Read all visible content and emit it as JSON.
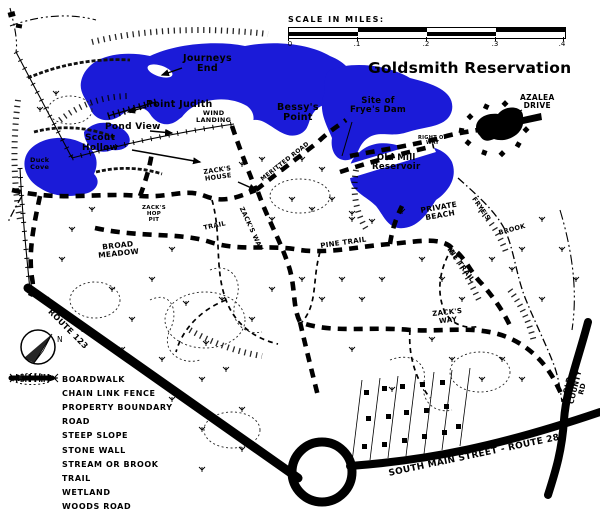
{
  "title": "Goldsmith Reservation",
  "scale": {
    "title": "SCALE IN MILES:",
    "ticks": [
      "0",
      ".1",
      ".2",
      ".3",
      ".4"
    ]
  },
  "compass": {
    "north_label": "N"
  },
  "colors": {
    "water": "#1b1bd8",
    "ink": "#000000"
  },
  "legend": {
    "items": [
      {
        "symbol": "boardwalk-icon",
        "label": "BOARDWALK"
      },
      {
        "symbol": "chain-link-fence-icon",
        "label": "CHAIN LINK FENCE"
      },
      {
        "symbol": "property-boundary-icon",
        "label": "PROPERTY BOUNDARY"
      },
      {
        "symbol": "road-icon",
        "label": "ROAD"
      },
      {
        "symbol": "steep-slope-icon",
        "label": "STEEP SLOPE"
      },
      {
        "symbol": "stone-wall-icon",
        "label": "STONE WALL"
      },
      {
        "symbol": "stream-or-brook-icon",
        "label": "STREAM OR BROOK"
      },
      {
        "symbol": "trail-icon",
        "label": "TRAIL"
      },
      {
        "symbol": "wetland-icon",
        "label": "WETLAND"
      },
      {
        "symbol": "woods-road-icon",
        "label": "WOODS ROAD"
      }
    ]
  },
  "map": {
    "labels": [
      {
        "name": "journeys-end",
        "text": "Journeys\nEnd",
        "x": 183,
        "y": 54,
        "size": 9.5,
        "bold": true
      },
      {
        "name": "point-judith",
        "text": "Point Judith",
        "x": 146,
        "y": 100,
        "size": 9.5,
        "bold": true
      },
      {
        "name": "pond-view",
        "text": "Pond View",
        "x": 105,
        "y": 123,
        "size": 9,
        "bold": true
      },
      {
        "name": "scout-hollow",
        "text": "Scout\nHollow",
        "x": 82,
        "y": 134,
        "size": 9,
        "bold": true
      },
      {
        "name": "wind-landing",
        "text": "WIND\nLANDING",
        "x": 196,
        "y": 110,
        "size": 6.5
      },
      {
        "name": "bessys-point",
        "text": "Bessy's\nPoint",
        "x": 277,
        "y": 103,
        "size": 9.5,
        "bold": true
      },
      {
        "name": "site-of-fryes-dam",
        "text": "Site of\nFrye's Dam",
        "x": 350,
        "y": 97,
        "size": 8.5,
        "bold": true
      },
      {
        "name": "old-mill-reservoir",
        "text": "Old Mill\nReservoir",
        "x": 372,
        "y": 154,
        "size": 8.5,
        "bold": true
      },
      {
        "name": "azalea-drive",
        "text": "AZALEA\nDRIVE",
        "x": 520,
        "y": 94,
        "size": 7.5
      },
      {
        "name": "right-of-way",
        "text": "RIGHT OF\nWAY",
        "x": 418,
        "y": 136,
        "size": 5
      },
      {
        "name": "duck-cove",
        "text": "Duck\nCove",
        "x": 30,
        "y": 157,
        "size": 6.5,
        "bold": true
      },
      {
        "name": "fryes-brook-1",
        "text": "FRYE'S",
        "x": 476,
        "y": 196,
        "size": 6.5,
        "rot": 55
      },
      {
        "name": "fryes-brook-2",
        "text": "BROOK",
        "x": 498,
        "y": 230,
        "size": 6.5,
        "rot": -15
      },
      {
        "name": "private-beach",
        "text": "PRIVATE\nBEACH",
        "x": 420,
        "y": 207,
        "size": 7.5,
        "rot": -10
      },
      {
        "name": "pine-trail-west",
        "text": "PINE TRAIL",
        "x": 320,
        "y": 243,
        "size": 7,
        "rot": -8
      },
      {
        "name": "pine-trail-east",
        "text": "PINE TRAIL",
        "x": 448,
        "y": 242,
        "size": 7,
        "rot": 54
      },
      {
        "name": "trail",
        "text": "TRAIL",
        "x": 203,
        "y": 225,
        "size": 6.5,
        "rot": -12
      },
      {
        "name": "zacks-house",
        "text": "ZACK'S\nHOUSE",
        "x": 203,
        "y": 169,
        "size": 6.5,
        "rot": -8
      },
      {
        "name": "zacks-hop-pit",
        "text": "ZACK'S\nHOP\nPIT",
        "x": 142,
        "y": 206,
        "size": 5.5
      },
      {
        "name": "broad-meadow",
        "text": "BROAD\nMEADOW",
        "x": 97,
        "y": 244,
        "size": 7.5,
        "rot": -6
      },
      {
        "name": "zacks-way-north",
        "text": "ZACK'S WAY",
        "x": 244,
        "y": 206,
        "size": 6.5,
        "rot": 65
      },
      {
        "name": "zacks-way-south",
        "text": "ZACK'S\nWAY",
        "x": 432,
        "y": 311,
        "size": 7,
        "rot": -6
      },
      {
        "name": "meritted-road",
        "text": "MERITTED ROAD",
        "x": 260,
        "y": 178,
        "size": 6,
        "rot": -38
      },
      {
        "name": "route-123",
        "text": "ROUTE 123",
        "x": 52,
        "y": 308,
        "size": 8,
        "rot": 45
      },
      {
        "name": "south-main-street",
        "text": "SOUTH MAIN STREET - ROUTE 28",
        "x": 388,
        "y": 470,
        "size": 9,
        "rot": -12
      },
      {
        "name": "old-county-rd",
        "text": "OLD COUNTY RD",
        "x": 560,
        "y": 404,
        "size": 7,
        "rot": -76
      }
    ]
  }
}
